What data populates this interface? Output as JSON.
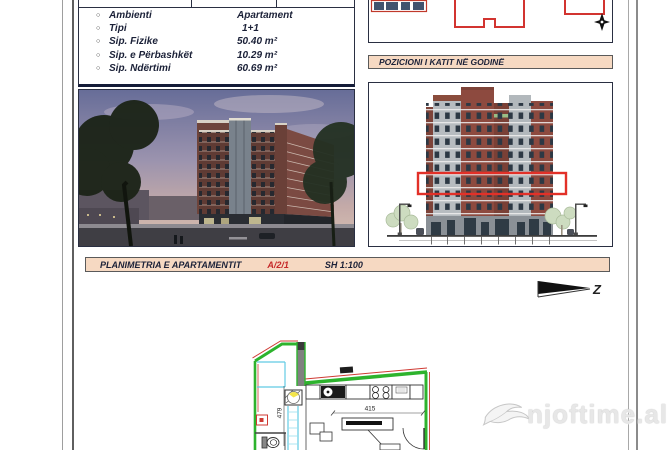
{
  "info_panel": {
    "bullet": "○",
    "rows": [
      {
        "label": "Ambienti",
        "value": "Apartament"
      },
      {
        "label": "Tipi",
        "value": "1+1"
      },
      {
        "label": "Sip. Fizike",
        "value": "50.40 m²"
      },
      {
        "label": "Sip. e Përbashkët",
        "value": "10.29 m²"
      },
      {
        "label": "Sip. Ndërtimi",
        "value": "60.69 m²"
      }
    ]
  },
  "position_header": {
    "title": "POZICIONI I KATIT NË GODINË"
  },
  "plan_header": {
    "title": "PLANIMETRIA E APARTAMENTIT",
    "code": "A/2/1",
    "scale": "SH 1:100"
  },
  "floor_plan": {
    "dim_width": "415",
    "dim_depth": "479"
  },
  "north_arrow": {
    "label": "Z"
  },
  "watermark": {
    "text": "njoftime.al"
  },
  "colors": {
    "header_bg": "#f6d9c2",
    "accent_red": "#d23430",
    "wall_green": "#2db32d",
    "window_cyan": "#62cbe4",
    "text_navy": "#1b2138",
    "watermark_gray": "#e7e7e7"
  }
}
